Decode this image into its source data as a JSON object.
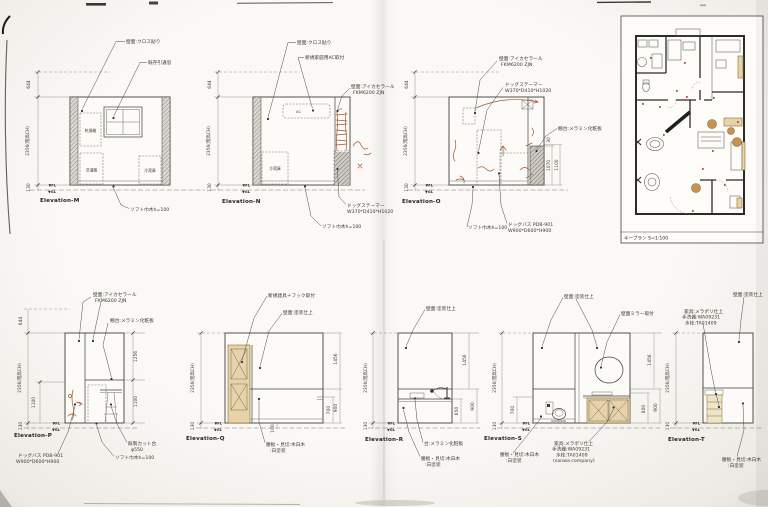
{
  "palette": {
    "line": "#3a3a38",
    "red_sketch": "#a8512e",
    "wood": "#e8d3a8",
    "leader_dot": "#24304d",
    "paper": "#f6f5f1"
  },
  "common": {
    "fl": "▼FL",
    "gl": "▼GL"
  },
  "key_plan": {
    "label": "キープラン S=1:100"
  },
  "elev_m": {
    "title": "Elevation-M",
    "dims": {
      "top": "644",
      "height": "2356(階高CH)",
      "base": "130"
    },
    "labels": {
      "wall": "壁面:クロス貼り",
      "window": "既存引違窓",
      "baseboard": "ソフト巾木h=100"
    },
    "items": {
      "dryer": "乾燥機",
      "washer": "洗濯機",
      "fridge": "冷蔵庫"
    }
  },
  "elev_n": {
    "title": "Elevation-N",
    "dims": {
      "top": "644",
      "height": "2356(階高CH)",
      "base": "130"
    },
    "labels": {
      "wall": "壁面:クロス貼り",
      "ac_mount": "新規家庭用AC取付",
      "wall2": [
        "壁面:アイカセラール",
        "FKM6200 ZJN"
      ],
      "steamer": [
        "ドッグステーマー",
        "W370*D410*H1020"
      ],
      "baseboard": "ソフト巾木h=100"
    },
    "items": {
      "ac": "AC",
      "fridge": "冷蔵庫"
    }
  },
  "elev_o": {
    "title": "Elevation-O",
    "dims": {
      "top": "644",
      "height": "2356(階高CH)",
      "base": "130",
      "shelf_thickness": "30",
      "shelf_height": "1070",
      "shelf_total": "1100"
    },
    "labels": {
      "wall": [
        "壁面:アイカセラール",
        "FKM6200 ZJN"
      ],
      "steamer": [
        "ドッグステーマー",
        "W370*D410*H1020"
      ],
      "shelf": "棚台:メラミン化粧板",
      "dogbath": [
        "ドッグバス PDB-901",
        "W900*D600*H900"
      ],
      "baseboard": "ソフト巾木h=100"
    }
  },
  "elev_p": {
    "title": "Elevation-P",
    "dims": {
      "top": "644",
      "height": "2356(階高CH)",
      "left_lower": "1100",
      "base": "130",
      "right_upper": "1256",
      "right_lower": "1100"
    },
    "labels": {
      "wall": [
        "壁面:アイカセラール",
        "FKM6200 ZJN"
      ],
      "shelf": "棚台:メラミン化粧板",
      "cut_table": [
        "既製カット台",
        "φ550"
      ],
      "dogbath": [
        "ドッグバス PDB-901",
        "W900*D600*H900"
      ],
      "baseboard": "ソフト巾木h=100"
    }
  },
  "elev_q": {
    "title": "Elevation-Q",
    "dims": {
      "height": "2356(階高CH)",
      "base": "130",
      "door_frame": "30",
      "door_height": "2000",
      "w_top": "30",
      "w_mid": "770",
      "w_base": "100",
      "right_upper": "1456",
      "right_inner": "700",
      "right_outer": "900"
    },
    "labels": {
      "door": "新規建具＋フック取付",
      "wall": "壁面:塗装仕上",
      "wainscot": [
        "腰板・見切:木白木",
        ":白塗装"
      ]
    }
  },
  "elev_r": {
    "title": "Elevation-R",
    "dims": {
      "height": "2356(階高CH)",
      "base": "130",
      "right_upper": "1456",
      "counter": "650",
      "right_outer": "900"
    },
    "labels": {
      "wall": "壁面:塗装仕上",
      "counter": "台:メラミン化粧板",
      "wainscot": [
        "腰板・見切:木白木",
        ":白塗装"
      ]
    }
  },
  "elev_s": {
    "title": "Elevation-S",
    "dims": {
      "height": "2356(階高CH)",
      "left_inner": "700",
      "base": "130",
      "mirror": "700",
      "counter_edge": "30",
      "cabinet": "670",
      "cabinet_w": "1000",
      "right_upper": "1456",
      "right_inner": "800",
      "right_outer": "900"
    },
    "labels": {
      "wall": "壁面:塗装仕上",
      "mirror": "壁面ミラー取付",
      "fixture": [
        "家具:メラポリ仕上",
        "手洗器:WA09231",
        "水栓:TA01409",
        "(sanwa company)"
      ],
      "wainscot": [
        "腰板・見切:木白木",
        ":白塗装"
      ]
    }
  },
  "elev_t": {
    "title": "Elevation-T",
    "dims": {
      "height": "2356(階高CH)",
      "base": "130"
    },
    "labels": {
      "wall": "壁面:塗装仕上",
      "fixture": [
        "家具:メラポリ仕上",
        "手洗器:WA09231",
        "水栓:TA01409"
      ],
      "wainscot": [
        "腰板・見切:木白木",
        ":白塗装"
      ]
    }
  }
}
